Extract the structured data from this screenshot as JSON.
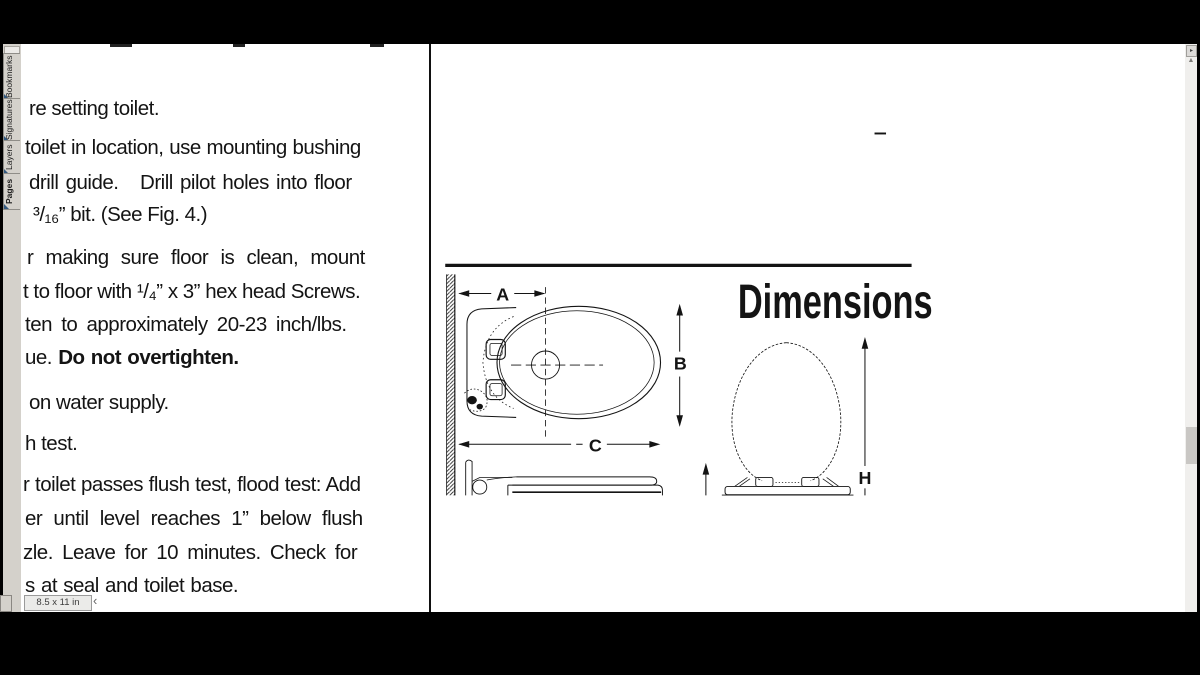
{
  "app": {
    "page_size_indicator": "8.5 x 11 in"
  },
  "icons": {
    "scroll_up": "▲",
    "panel_corner": "▸",
    "scroll_left": "‹"
  },
  "sidebar": {
    "tabs": [
      {
        "label": "Bookmarks",
        "active": false
      },
      {
        "label": "Signatures",
        "active": false
      },
      {
        "label": "Layers",
        "active": false
      },
      {
        "label": "Pages",
        "active": true
      }
    ]
  },
  "document": {
    "lines": [
      [
        {
          "t": "re setting toilet.",
          "b": false
        }
      ],
      [
        {
          "t": "toilet in location, use mounting bushing",
          "b": false
        }
      ],
      [
        {
          "t": "drill guide.   Drill pilot holes into floor",
          "b": false
        }
      ],
      [
        {
          "t": "³/₁₆” bit. (See Fig. 4.)",
          "b": false
        }
      ],
      [
        {
          "t": "r making sure floor is clean, mount",
          "b": false
        }
      ],
      [
        {
          "t": "t to floor with ¹/₄” x 3” hex head Screws.",
          "b": false
        }
      ],
      [
        {
          "t": "ten to approximately 20-23 inch/lbs.",
          "b": false
        }
      ],
      [
        {
          "t": "ue. ",
          "b": false
        },
        {
          "t": "Do not overtighten.",
          "b": true
        }
      ],
      [
        {
          "t": "on water supply.",
          "b": false
        }
      ],
      [
        {
          "t": "h test.",
          "b": false
        }
      ],
      [
        {
          "t": "r toilet passes flush test, flood test: Add",
          "b": false
        }
      ],
      [
        {
          "t": "er until level reaches 1” below flush",
          "b": false
        }
      ],
      [
        {
          "t": "zle. Leave for 10 minutes. Check for",
          "b": false
        }
      ],
      [
        {
          "t": "s at seal and toilet base.",
          "b": false
        }
      ],
      [
        {
          "t": "ch Bolt Covers.",
          "b": false
        }
      ],
      [
        {
          "t": "until ",
          "b": false
        },
        {
          "t": "Warranty Registration",
          "b": true
        }
      ]
    ],
    "diagram": {
      "title": "Dimensions",
      "dimension_labels": {
        "a": "A",
        "b": "B",
        "c": "C",
        "h": "H"
      }
    }
  }
}
